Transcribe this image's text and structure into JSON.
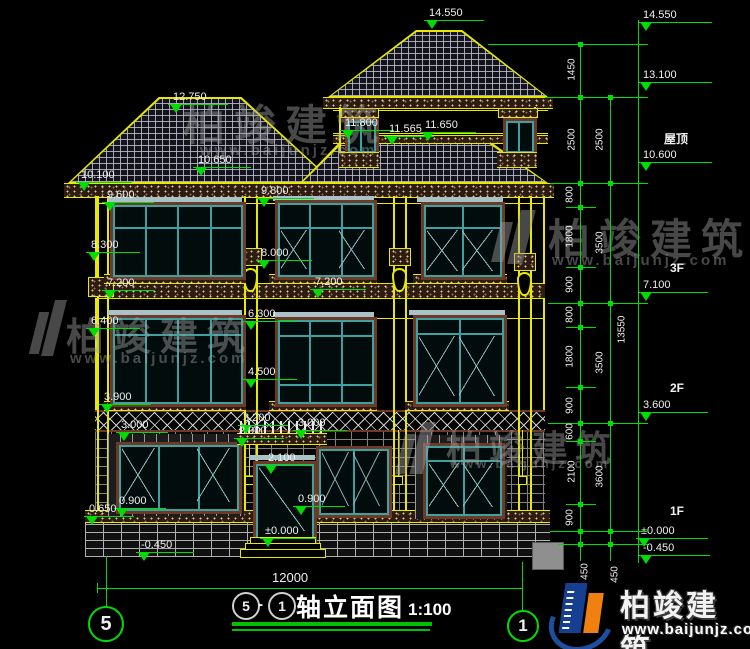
{
  "title": {
    "axis_a": "5",
    "dash": "-",
    "axis_b": "1",
    "text": "轴立面图",
    "scale": "1:100",
    "bubble_left": "5",
    "bubble_right": "1"
  },
  "watermark": {
    "brand": "柏竣建筑",
    "site": "www.baijunjz.com"
  },
  "logo": {
    "brand": "柏竣建筑",
    "site": "www.baijunjz.com"
  },
  "marks_left": [
    {
      "v": "10.100"
    },
    {
      "v": "9.600"
    },
    {
      "v": "8.300"
    },
    {
      "v": "7.200"
    },
    {
      "v": "6.400"
    },
    {
      "v": "3.900"
    },
    {
      "v": "3.000"
    },
    {
      "v": "0.900"
    },
    {
      "v": "0.650"
    },
    {
      "v": "-0.450"
    }
  ],
  "marks_center": [
    {
      "v": "14.550"
    },
    {
      "v": "12.750"
    },
    {
      "v": "11.800"
    },
    {
      "v": "11.565"
    },
    {
      "v": "11.650"
    },
    {
      "v": "10.650"
    },
    {
      "v": "9.800"
    },
    {
      "v": "8.000"
    },
    {
      "v": "7.200"
    },
    {
      "v": "6.300"
    },
    {
      "v": "4.500"
    },
    {
      "v": "3.200"
    },
    {
      "v": "2.900"
    },
    {
      "v": "3.000"
    },
    {
      "v": "2.100"
    },
    {
      "v": "0.900"
    },
    {
      "v": "±0.000"
    }
  ],
  "marks_right": [
    {
      "f": "",
      "v": "14.550"
    },
    {
      "f": "",
      "v": "13.100"
    },
    {
      "f": "屋顶",
      "v": "10.600"
    },
    {
      "f": "3F",
      "v": "7.100"
    },
    {
      "f": "2F",
      "v": "3.600"
    },
    {
      "f": "1F",
      "v": "±0.000"
    },
    {
      "f": "",
      "v": "-0.450"
    }
  ],
  "dims_inner": [
    {
      "v": "1450"
    },
    {
      "v": "2500"
    },
    {
      "v": "800"
    },
    {
      "v": "1800"
    },
    {
      "v": "900"
    },
    {
      "v": "800"
    },
    {
      "v": "1800"
    },
    {
      "v": "900"
    },
    {
      "v": "600"
    },
    {
      "v": "2100"
    },
    {
      "v": "900"
    }
  ],
  "dims_outer": [
    {
      "v": "2500"
    },
    {
      "v": "3500"
    },
    {
      "v": "3500"
    },
    {
      "v": "3600"
    }
  ],
  "dims_misc": {
    "total": "13550",
    "width": "12000",
    "a450": "450",
    "b450": "450"
  },
  "colors": {
    "bg": "#000000",
    "dim_green": "#00dd00",
    "cad_yellow": "#e8e800",
    "frame_teal": "#3fa0a0",
    "casing_brown": "#6e3a28",
    "logo_blue": "#1c4fa0",
    "logo_orange": "#f08010"
  }
}
